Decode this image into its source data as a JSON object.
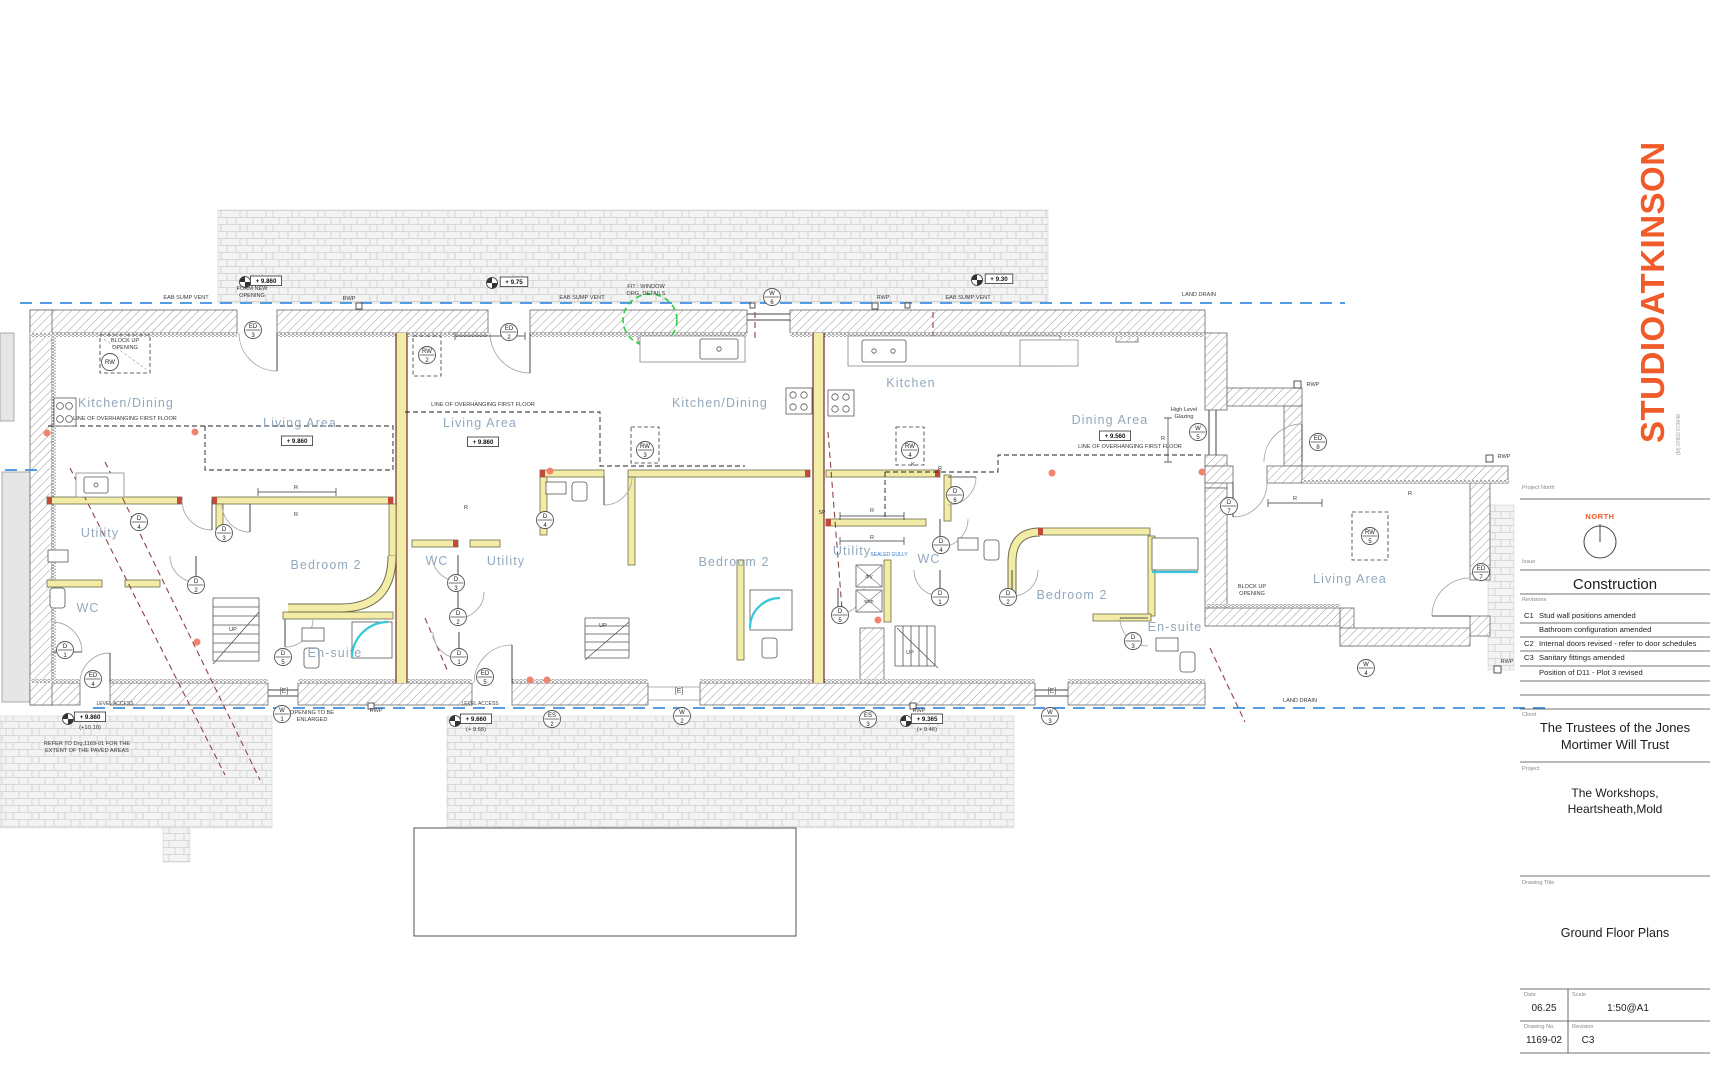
{
  "title_block": {
    "logo": "STUDIOATKINSON",
    "phone": "(M) 07803 673648",
    "project_north_label": "Project North",
    "north_label": "NORTH",
    "issue_label": "Issue",
    "issue_value": "Construction",
    "revisions_label": "Revisions",
    "revisions": [
      {
        "code": "C1",
        "text": "Stud wall positions amended"
      },
      {
        "code": "",
        "text": "Bathroom configuration amended"
      },
      {
        "code": "C2",
        "text": "Internal doors revised - refer to door schedules"
      },
      {
        "code": "C3",
        "text": "Sanitary fittings amended"
      },
      {
        "code": "",
        "text": "Position of D11 - Plot 3 revised"
      }
    ],
    "client_label": "Client",
    "client_lines": [
      "The Trustees of the Jones",
      "Mortimer Will Trust"
    ],
    "project_label": "Project",
    "project_lines": [
      "The Workshops,",
      "Heartsheath,Mold"
    ],
    "drawing_title_label": "Drawing Title",
    "drawing_title": "Ground Floor Plans",
    "date_label": "Date",
    "date": "06.25",
    "scale_label": "Scale",
    "scale": "1:50@A1",
    "drawing_no_label": "Drawing No.",
    "drawing_no": "1169-02",
    "revision_label": "Revision",
    "revision": "C3"
  },
  "plan": {
    "room_labels": [
      {
        "x": 126,
        "y": 407,
        "t": "Kitchen/Dining"
      },
      {
        "x": 300,
        "y": 427,
        "t": "Living Area"
      },
      {
        "x": 100,
        "y": 537,
        "t": "Utility"
      },
      {
        "x": 88,
        "y": 612,
        "t": "WC"
      },
      {
        "x": 326,
        "y": 569,
        "t": "Bedroom 2"
      },
      {
        "x": 335,
        "y": 657,
        "t": "En-suite"
      },
      {
        "x": 480,
        "y": 427,
        "t": "Living Area"
      },
      {
        "x": 720,
        "y": 407,
        "t": "Kitchen/Dining"
      },
      {
        "x": 437,
        "y": 565,
        "t": "WC"
      },
      {
        "x": 506,
        "y": 565,
        "t": "Utility"
      },
      {
        "x": 734,
        "y": 566,
        "t": "Bedroom 2"
      },
      {
        "x": 911,
        "y": 387,
        "t": "Kitchen"
      },
      {
        "x": 1110,
        "y": 424,
        "t": "Dining Area"
      },
      {
        "x": 852,
        "y": 555,
        "t": "Utility"
      },
      {
        "x": 929,
        "y": 563,
        "t": "WC"
      },
      {
        "x": 1072,
        "y": 599,
        "t": "Bedroom 2"
      },
      {
        "x": 1175,
        "y": 631,
        "t": "En-suite"
      },
      {
        "x": 1350,
        "y": 583,
        "t": "Living Area"
      }
    ],
    "annotations": [
      {
        "x": 186,
        "y": 299,
        "t": "EAB SUMP VENT"
      },
      {
        "x": 582,
        "y": 299,
        "t": "EAB SUMP VENT"
      },
      {
        "x": 968,
        "y": 299,
        "t": "EAB SUMP VENT"
      },
      {
        "x": 252,
        "y": 290,
        "t": "FORM NEW"
      },
      {
        "x": 252,
        "y": 297,
        "t": "OPENING"
      },
      {
        "x": 349,
        "y": 300,
        "t": "RWP"
      },
      {
        "x": 883,
        "y": 299,
        "t": "RWP"
      },
      {
        "x": 1313,
        "y": 386,
        "t": "RWP"
      },
      {
        "x": 1504,
        "y": 458,
        "t": "RWP"
      },
      {
        "x": 376,
        "y": 712,
        "t": "RWP"
      },
      {
        "x": 919,
        "y": 712,
        "t": "RWP"
      },
      {
        "x": 1507,
        "y": 663,
        "t": "RWP"
      },
      {
        "x": 1199,
        "y": 296,
        "t": "LAND DRAIN"
      },
      {
        "x": 1300,
        "y": 702,
        "t": "LAND DRAIN"
      },
      {
        "x": 646,
        "y": 288,
        "t": "FIT : WINDOW"
      },
      {
        "x": 646,
        "y": 295,
        "t": "DRG. DETAILS"
      },
      {
        "x": 125,
        "y": 342,
        "t": "BLOCK UP"
      },
      {
        "x": 125,
        "y": 349,
        "t": "OPENING"
      },
      {
        "x": 1252,
        "y": 588,
        "t": "BLOCK UP"
      },
      {
        "x": 1252,
        "y": 595,
        "t": "OPENING"
      },
      {
        "x": 125,
        "y": 420,
        "t": "LINE OF OVERHANGING FIRST FLOOR"
      },
      {
        "x": 483,
        "y": 406,
        "t": "LINE OF OVERHANGING FIRST FLOOR"
      },
      {
        "x": 1130,
        "y": 448,
        "t": "LINE OF OVERHANGING FIRST FLOOR"
      },
      {
        "x": 1184,
        "y": 411,
        "t": "High Level"
      },
      {
        "x": 1184,
        "y": 418,
        "t": "Glazing"
      },
      {
        "x": 889,
        "y": 556,
        "t": "SEALED GULLY",
        "cls": "blue"
      },
      {
        "x": 869,
        "y": 578,
        "t": "dry",
        "cls": "tiny5"
      },
      {
        "x": 869,
        "y": 603,
        "t": "w/m",
        "cls": "tiny5"
      },
      {
        "x": 312,
        "y": 714,
        "t": "OPENING TO BE"
      },
      {
        "x": 312,
        "y": 721,
        "t": "ENLARGED"
      },
      {
        "x": 115,
        "y": 705,
        "t": "LEVEL ACCESS",
        "cls": "tiny5"
      },
      {
        "x": 480,
        "y": 705,
        "t": "LEVEL ACCESS",
        "cls": "tiny5"
      },
      {
        "x": 87,
        "y": 745,
        "t": "REFER TO Drg.1169-01 FOR THE"
      },
      {
        "x": 87,
        "y": 752,
        "t": "EXTENT OF THE PAVED AREAS"
      },
      {
        "x": 233,
        "y": 631,
        "t": "UP"
      },
      {
        "x": 603,
        "y": 627,
        "t": "UP"
      },
      {
        "x": 910,
        "y": 654,
        "t": "UP"
      },
      {
        "x": 284,
        "y": 693,
        "t": "[E]",
        "cls": "etag"
      },
      {
        "x": 679,
        "y": 693,
        "t": "[E]",
        "cls": "etag"
      },
      {
        "x": 1052,
        "y": 693,
        "t": "[E]",
        "cls": "etag"
      },
      {
        "x": 296,
        "y": 489,
        "t": "R"
      },
      {
        "x": 296,
        "y": 516,
        "t": "R"
      },
      {
        "x": 466,
        "y": 509,
        "t": "R"
      },
      {
        "x": 872,
        "y": 512,
        "t": "R"
      },
      {
        "x": 872,
        "y": 539,
        "t": "R"
      },
      {
        "x": 1163,
        "y": 440,
        "t": "R"
      },
      {
        "x": 1295,
        "y": 500,
        "t": "R"
      },
      {
        "x": 940,
        "y": 470,
        "t": "R"
      },
      {
        "x": 1410,
        "y": 495,
        "t": "R"
      },
      {
        "x": 913,
        "y": 466,
        "t": "K"
      },
      {
        "x": 822,
        "y": 514,
        "t": "SP",
        "cls": "tiny5"
      }
    ],
    "tags": [
      {
        "x": 253,
        "y": 330,
        "n": "ED",
        "d": "3"
      },
      {
        "x": 509,
        "y": 332,
        "n": "ED",
        "d": "2"
      },
      {
        "x": 485,
        "y": 677,
        "n": "ED",
        "d": "5"
      },
      {
        "x": 93,
        "y": 679,
        "n": "ED",
        "d": "4"
      },
      {
        "x": 1318,
        "y": 442,
        "n": "ED",
        "d": "8"
      },
      {
        "x": 1481,
        "y": 572,
        "n": "ED",
        "d": "7"
      },
      {
        "x": 772,
        "y": 297,
        "n": "W",
        "d": "6"
      },
      {
        "x": 1198,
        "y": 432,
        "n": "W",
        "d": "5"
      },
      {
        "x": 282,
        "y": 714,
        "n": "W",
        "d": "1"
      },
      {
        "x": 682,
        "y": 716,
        "n": "W",
        "d": "2"
      },
      {
        "x": 1050,
        "y": 716,
        "n": "W",
        "d": "3"
      },
      {
        "x": 1366,
        "y": 668,
        "n": "W",
        "d": "4"
      },
      {
        "x": 65,
        "y": 650,
        "n": "D",
        "d": "1"
      },
      {
        "x": 196,
        "y": 585,
        "n": "D",
        "d": "2"
      },
      {
        "x": 224,
        "y": 533,
        "n": "D",
        "d": "3"
      },
      {
        "x": 139,
        "y": 522,
        "n": "D",
        "d": "4"
      },
      {
        "x": 283,
        "y": 657,
        "n": "D",
        "d": "5"
      },
      {
        "x": 545,
        "y": 520,
        "n": "D",
        "d": "4"
      },
      {
        "x": 456,
        "y": 583,
        "n": "D",
        "d": "3"
      },
      {
        "x": 458,
        "y": 617,
        "n": "D",
        "d": "2"
      },
      {
        "x": 459,
        "y": 657,
        "n": "D",
        "d": "1"
      },
      {
        "x": 955,
        "y": 495,
        "n": "D",
        "d": "6"
      },
      {
        "x": 941,
        "y": 545,
        "n": "D",
        "d": "4"
      },
      {
        "x": 940,
        "y": 597,
        "n": "D",
        "d": "1"
      },
      {
        "x": 1008,
        "y": 597,
        "n": "D",
        "d": "2"
      },
      {
        "x": 840,
        "y": 615,
        "n": "D",
        "d": "5"
      },
      {
        "x": 1133,
        "y": 641,
        "n": "D",
        "d": "3"
      },
      {
        "x": 1229,
        "y": 506,
        "n": "D",
        "d": "7"
      },
      {
        "x": 110,
        "y": 362,
        "n": "RW",
        "d": ""
      },
      {
        "x": 427,
        "y": 355,
        "n": "RW",
        "d": "2"
      },
      {
        "x": 645,
        "y": 450,
        "n": "RW",
        "d": "3"
      },
      {
        "x": 910,
        "y": 450,
        "n": "RW",
        "d": "4"
      },
      {
        "x": 1370,
        "y": 536,
        "n": "RW",
        "d": "5"
      },
      {
        "x": 552,
        "y": 719,
        "n": "ES",
        "d": "2"
      },
      {
        "x": 868,
        "y": 719,
        "n": "ES",
        "d": "3"
      }
    ],
    "levels": [
      {
        "x": 266,
        "y": 283,
        "t": "+ 9.860"
      },
      {
        "x": 514,
        "y": 284,
        "t": "+ 9.75"
      },
      {
        "x": 999,
        "y": 281,
        "t": "+ 9.30"
      },
      {
        "x": 297,
        "y": 443,
        "t": "+ 9.860"
      },
      {
        "x": 483,
        "y": 444,
        "t": "+ 9.860"
      },
      {
        "x": 1115,
        "y": 438,
        "t": "+ 9.560"
      },
      {
        "x": 90,
        "y": 719,
        "t": "+ 9.860",
        "t2": "(+10.10)"
      },
      {
        "x": 476,
        "y": 721,
        "t": "+ 9.660",
        "t2": "(+ 9.65)"
      },
      {
        "x": 927,
        "y": 721,
        "t": "+ 9.365",
        "t2": "(+ 9.46)"
      }
    ]
  },
  "colors": {
    "accent_orange": "#F15A29",
    "drain_blue": "#3E8EE0",
    "room_label": "#92A8BE",
    "stud_yellow": "#F2ECA6",
    "shower_cyan": "#35C8D8",
    "detail_green": "#2FCC44",
    "marker_red": "#F4836E"
  }
}
